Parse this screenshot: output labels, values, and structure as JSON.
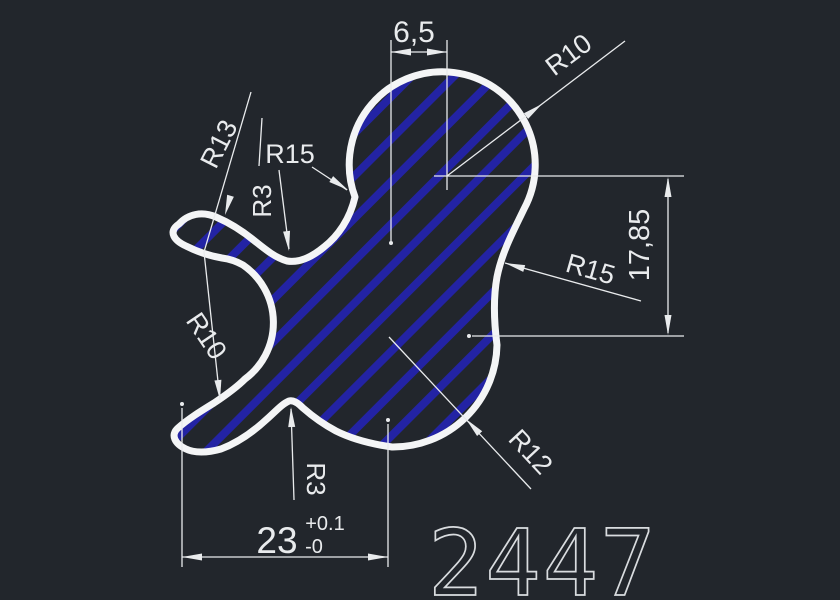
{
  "window": {
    "type": "cad-viewport",
    "background_color": "#22262c",
    "outline_color": "#f4f5f6",
    "hatch_color": "#2323a4",
    "dimension_color": "#e9ebed"
  },
  "drawing": {
    "part_number": "2447",
    "labels": {
      "top_width": "6,5",
      "right_height": "17,85",
      "radius_top_circle": "R10",
      "radius_left_outer": "R13",
      "radius_left_mid": "R15",
      "radius_notch_top": "R3",
      "radius_left_inner": "R10",
      "radius_waist_right": "R15",
      "radius_lobe_bottom": "R12",
      "radius_notch_bottom": "R3",
      "bottom_width_nominal": "23",
      "bottom_width_tol_upper": "+0.1",
      "bottom_width_tol_lower": "-0"
    }
  }
}
